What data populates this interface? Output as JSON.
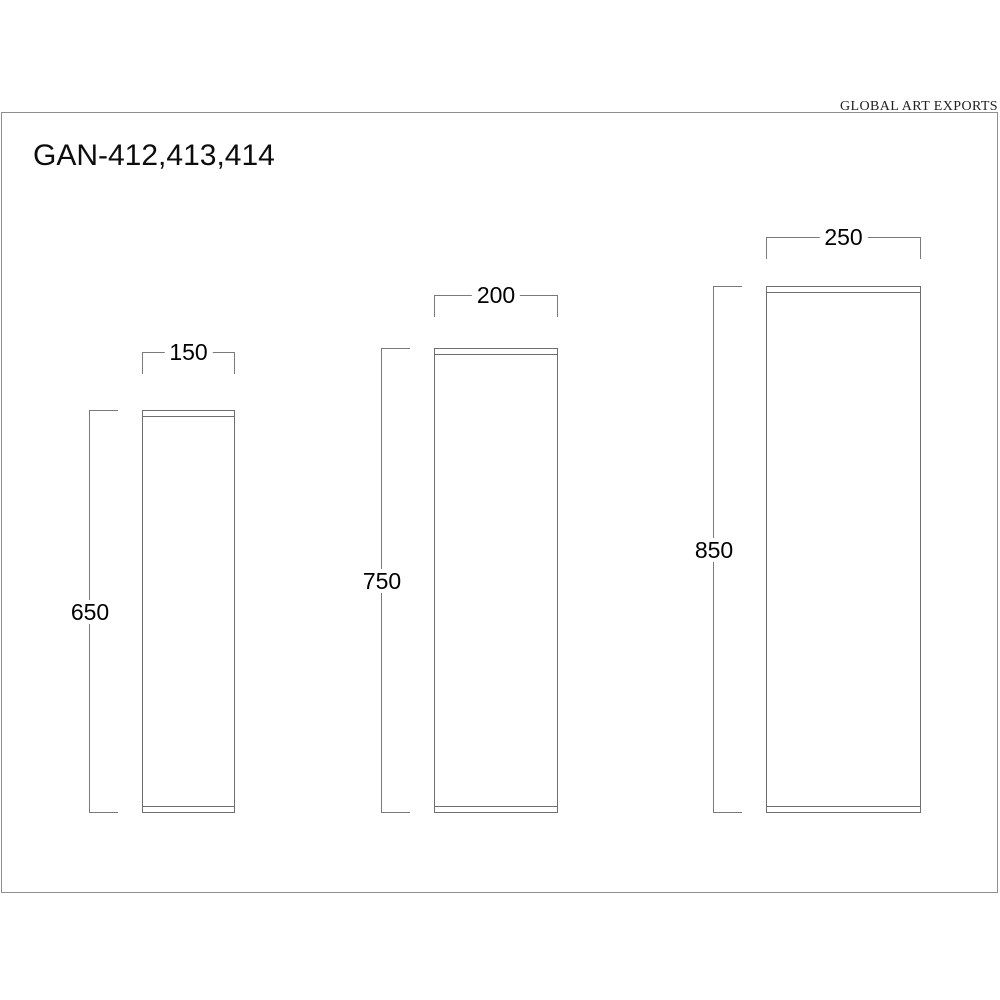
{
  "header": {
    "brand": "GLOBAL ART EXPORTS",
    "title": "GAN-412,413,414"
  },
  "pedestals": [
    {
      "width_label": "150",
      "height_label": "650",
      "width": 150,
      "height": 650
    },
    {
      "width_label": "200",
      "height_label": "750",
      "width": 200,
      "height": 750
    },
    {
      "width_label": "250",
      "height_label": "850",
      "width": 250,
      "height": 850
    }
  ],
  "colors": {
    "line": "#6e6e6e",
    "dim_line": "#7a7a7a",
    "frame": "#8f8f8f",
    "text": "#000000"
  }
}
